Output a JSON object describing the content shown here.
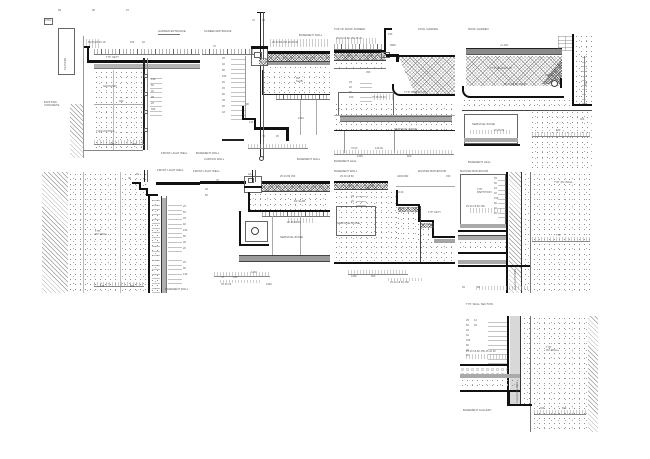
{
  "sheet": {
    "description": "Architectural construction detail drawings sheet, nine section details",
    "colors": {
      "ink": "#1a1a1a",
      "mid_grey": "#8c8c8c",
      "light_grey": "#d8d8d8",
      "text": "#555555",
      "paper": "#ffffff"
    }
  },
  "panels": [
    {
      "id": "t1",
      "name": "garden-entrance-detail",
      "labels": [
        {
          "t": "05",
          "x": 58,
          "y": 9,
          "s": 2.6
        },
        {
          "t": "06",
          "x": 92,
          "y": 9,
          "s": 2.6
        },
        {
          "t": "07",
          "x": 126,
          "y": 9,
          "s": 2.6
        },
        {
          "t": "CTRL",
          "x": 45,
          "y": 20,
          "s": 2.4
        },
        {
          "t": "PLANTER",
          "x": 64,
          "y": 70,
          "r": -90,
          "s": 2.6
        },
        {
          "t": "GARDEN ENTRANCE",
          "x": 158,
          "y": 30,
          "s": 2.7
        },
        {
          "t": "50 80 25 40 18",
          "x": 88,
          "y": 41,
          "s": 2.5
        },
        {
          "t": "150",
          "x": 130,
          "y": 41,
          "s": 2.5
        },
        {
          "t": "40",
          "x": 142,
          "y": 41,
          "s": 2.5
        },
        {
          "t": "TYP. SETT",
          "x": 106,
          "y": 56,
          "s": 2.5
        },
        {
          "t": "GROUND",
          "x": 103,
          "y": 85,
          "s": 3
        },
        {
          "t": "300",
          "x": 119,
          "y": 100,
          "s": 2.5
        },
        {
          "t": "EXISTING\nCONCRETE",
          "x": 44,
          "y": 101,
          "s": 2.7
        },
        {
          "t": "TILE PAVING",
          "x": 96,
          "y": 130,
          "s": 3
        },
        {
          "t": "150",
          "x": 151,
          "y": 78,
          "s": 2.5
        },
        {
          "t": "80",
          "x": 151,
          "y": 84,
          "s": 2.5
        },
        {
          "t": "40",
          "x": 151,
          "y": 90,
          "s": 2.5
        },
        {
          "t": "25",
          "x": 151,
          "y": 96,
          "s": 2.5
        },
        {
          "t": "20",
          "x": 151,
          "y": 102,
          "s": 2.5
        },
        {
          "t": "300",
          "x": 151,
          "y": 108,
          "s": 2.5
        },
        {
          "t": "185",
          "x": 110,
          "y": 143,
          "s": 2.5
        },
        {
          "t": "260",
          "x": 132,
          "y": 143,
          "s": 2.5
        },
        {
          "t": "FRONT LIGHT WELL",
          "x": 161,
          "y": 152,
          "s": 2.7
        },
        {
          "t": "BASEMENT WALL",
          "x": 196,
          "y": 152,
          "s": 2.7
        }
      ]
    },
    {
      "id": "t2",
      "name": "screen-entrance-detail",
      "labels": [
        {
          "t": "SCREEN ENTRANCE",
          "x": 204,
          "y": 30,
          "s": 2.7
        },
        {
          "t": "BASEMENT WALL",
          "x": 299,
          "y": 34,
          "s": 2.7
        },
        {
          "t": "70",
          "x": 252,
          "y": 19,
          "s": 2.5
        },
        {
          "t": "45",
          "x": 262,
          "y": 19,
          "s": 2.5
        },
        {
          "t": "70",
          "x": 213,
          "y": 45,
          "s": 2.5
        },
        {
          "t": "25 40 80 150 20 45 90",
          "x": 272,
          "y": 41,
          "s": 2.5
        },
        {
          "t": "25",
          "x": 222,
          "y": 57,
          "s": 2.5
        },
        {
          "t": "40",
          "x": 222,
          "y": 63,
          "s": 2.5
        },
        {
          "t": "80",
          "x": 222,
          "y": 69,
          "s": 2.5
        },
        {
          "t": "150",
          "x": 222,
          "y": 75,
          "s": 2.5
        },
        {
          "t": "20",
          "x": 222,
          "y": 81,
          "s": 2.5
        },
        {
          "t": "45",
          "x": 222,
          "y": 87,
          "s": 2.5
        },
        {
          "t": "90",
          "x": 222,
          "y": 93,
          "s": 2.5
        },
        {
          "t": "35",
          "x": 222,
          "y": 99,
          "s": 2.5
        },
        {
          "t": "60",
          "x": 222,
          "y": 105,
          "s": 2.5
        },
        {
          "t": "18",
          "x": 222,
          "y": 111,
          "s": 2.5
        },
        {
          "t": "RC\nSLAB",
          "x": 296,
          "y": 77,
          "s": 2.5
        },
        {
          "t": "90",
          "x": 246,
          "y": 103,
          "s": 2.5
        },
        {
          "t": "140",
          "x": 249,
          "y": 121,
          "s": 2.5
        },
        {
          "t": "70",
          "x": 262,
          "y": 135,
          "s": 2.5
        },
        {
          "t": "45",
          "x": 276,
          "y": 135,
          "s": 2.5
        },
        {
          "t": "2120",
          "x": 298,
          "y": 117,
          "s": 2.5
        },
        {
          "t": "CURTAIN WALL",
          "x": 204,
          "y": 158,
          "s": 2.7
        },
        {
          "t": "BASEMENT WALL",
          "x": 297,
          "y": 158,
          "s": 2.7
        }
      ]
    },
    {
      "id": "t3",
      "name": "roof-screed-detail",
      "labels": [
        {
          "t": "TOP OF ROOF SCREED",
          "x": 334,
          "y": 28,
          "s": 2.7
        },
        {
          "t": "POOL GARDEN",
          "x": 418,
          "y": 28,
          "s": 2.7
        },
        {
          "t": "25 40 18 80 150 45 20",
          "x": 336,
          "y": 37,
          "s": 2.5
        },
        {
          "t": "150",
          "x": 388,
          "y": 33,
          "s": 2.5
        },
        {
          "t": "RWP",
          "x": 390,
          "y": 44,
          "s": 2.5
        },
        {
          "t": "450",
          "x": 366,
          "y": 71,
          "s": 2.5
        },
        {
          "t": "25",
          "x": 349,
          "y": 81,
          "s": 2.5
        },
        {
          "t": "40",
          "x": 349,
          "y": 86,
          "s": 2.5
        },
        {
          "t": "80",
          "x": 349,
          "y": 91,
          "s": 2.5
        },
        {
          "t": "150",
          "x": 349,
          "y": 96,
          "s": 2.5
        },
        {
          "t": "70 45 20 40",
          "x": 372,
          "y": 96,
          "s": 2.5
        },
        {
          "t": "TYP. BUILD-UP",
          "x": 404,
          "y": 91,
          "s": 3
        },
        {
          "t": "SERVICE ZONE",
          "x": 394,
          "y": 128,
          "s": 3
        },
        {
          "t": "70.00",
          "x": 351,
          "y": 147,
          "s": 2.5
        },
        {
          "t": "140.00",
          "x": 375,
          "y": 147,
          "s": 2.5
        },
        {
          "t": "1200",
          "x": 357,
          "y": 155,
          "s": 2.5
        },
        {
          "t": "600",
          "x": 407,
          "y": 155,
          "s": 2.5
        },
        {
          "t": "BASEMENT HALL",
          "x": 334,
          "y": 160,
          "s": 2.7
        }
      ]
    },
    {
      "id": "t4",
      "name": "roof-garden-detail",
      "labels": [
        {
          "t": "ROOF GARDEN",
          "x": 468,
          "y": 28,
          "s": 2.7
        },
        {
          "t": "+2.150",
          "x": 500,
          "y": 44,
          "s": 2.5
        },
        {
          "t": "TYP. BUILD-UP",
          "x": 490,
          "y": 67,
          "s": 3
        },
        {
          "t": "25 40 18 80 150 45",
          "x": 504,
          "y": 83,
          "s": 2.5
        },
        {
          "t": "100Ø",
          "x": 545,
          "y": 74,
          "s": 2.5
        },
        {
          "t": "SERVICE ZONE",
          "x": 472,
          "y": 123,
          "s": 3
        },
        {
          "t": "20 45 90",
          "x": 494,
          "y": 129,
          "s": 2.5
        },
        {
          "t": "600",
          "x": 556,
          "y": 129,
          "s": 2.5
        },
        {
          "t": "450",
          "x": 585,
          "y": 86,
          "r": -90,
          "s": 2.5
        },
        {
          "t": "300",
          "x": 580,
          "y": 118,
          "s": 2.5
        },
        {
          "t": "BASEMENT HALL",
          "x": 468,
          "y": 161,
          "s": 2.7
        }
      ]
    },
    {
      "id": "m1",
      "name": "front-lightwell-wall-detail",
      "labels": [
        {
          "t": "FRONT LIGHT WELL",
          "x": 157,
          "y": 169,
          "s": 2.7
        },
        {
          "t": "70",
          "x": 128,
          "y": 177,
          "s": 2.5
        },
        {
          "t": "45",
          "x": 136,
          "y": 173,
          "s": 2.5
        },
        {
          "t": "TYP.\nRC WALL",
          "x": 95,
          "y": 230,
          "s": 2.7
        },
        {
          "t": "25",
          "x": 183,
          "y": 205,
          "s": 2.5
        },
        {
          "t": "50",
          "x": 183,
          "y": 211,
          "s": 2.5
        },
        {
          "t": "18",
          "x": 183,
          "y": 217,
          "s": 2.5
        },
        {
          "t": "40",
          "x": 183,
          "y": 223,
          "s": 2.5
        },
        {
          "t": "150",
          "x": 183,
          "y": 229,
          "s": 2.5
        },
        {
          "t": "80",
          "x": 183,
          "y": 235,
          "s": 2.5
        },
        {
          "t": "30",
          "x": 183,
          "y": 241,
          "s": 2.5
        },
        {
          "t": "20",
          "x": 183,
          "y": 247,
          "s": 2.5
        },
        {
          "t": "45",
          "x": 183,
          "y": 261,
          "s": 2.5
        },
        {
          "t": "90",
          "x": 183,
          "y": 267,
          "s": 2.5
        },
        {
          "t": "120",
          "x": 183,
          "y": 273,
          "s": 2.5
        },
        {
          "t": "185",
          "x": 100,
          "y": 285,
          "s": 2.5
        },
        {
          "t": "260",
          "x": 130,
          "y": 285,
          "s": 2.5
        },
        {
          "t": "BASEMENT WALL",
          "x": 165,
          "y": 288,
          "s": 2.7
        }
      ]
    },
    {
      "id": "m2",
      "name": "basement-hall-soffit-detail",
      "labels": [
        {
          "t": "FRONT LIGHT WELL",
          "x": 193,
          "y": 170,
          "s": 2.7
        },
        {
          "t": "AA",
          "x": 248,
          "y": 173,
          "s": 2.5
        },
        {
          "t": "70",
          "x": 216,
          "y": 179,
          "s": 2.5
        },
        {
          "t": "25",
          "x": 205,
          "y": 188,
          "s": 2.5
        },
        {
          "t": "50",
          "x": 205,
          "y": 194,
          "s": 2.5
        },
        {
          "t": "25 40 80 150",
          "x": 280,
          "y": 175,
          "s": 2.5
        },
        {
          "t": "RC SLAB",
          "x": 294,
          "y": 200,
          "s": 2.5
        },
        {
          "t": "20 45 90 35",
          "x": 287,
          "y": 221,
          "s": 2.5
        },
        {
          "t": "SERVICE ZONE",
          "x": 280,
          "y": 236,
          "s": 3
        },
        {
          "t": "1200",
          "x": 251,
          "y": 271,
          "s": 2.5
        },
        {
          "t": "70",
          "x": 221,
          "y": 276,
          "s": 2.5
        },
        {
          "t": "240",
          "x": 233,
          "y": 276,
          "s": 2.5
        },
        {
          "t": "25 40 18",
          "x": 221,
          "y": 283,
          "s": 2.5
        },
        {
          "t": "2400",
          "x": 266,
          "y": 283,
          "s": 2.5
        }
      ]
    },
    {
      "id": "m3",
      "name": "stepped-terrace-detail",
      "labels": [
        {
          "t": "BASEMENT WALL",
          "x": 334,
          "y": 170,
          "s": 2.7
        },
        {
          "t": "MASTER BATHROOM",
          "x": 418,
          "y": 170,
          "s": 2.7
        },
        {
          "t": "25 40 18 80",
          "x": 340,
          "y": 175,
          "s": 2.5
        },
        {
          "t": "GROUND",
          "x": 397,
          "y": 175,
          "s": 2.5
        },
        {
          "t": "150",
          "x": 446,
          "y": 175,
          "s": 2.5
        },
        {
          "t": "150",
          "x": 365,
          "y": 187,
          "s": 2.5
        },
        {
          "t": "45",
          "x": 351,
          "y": 195,
          "s": 2.5
        },
        {
          "t": "20",
          "x": 351,
          "y": 200,
          "s": 2.5
        },
        {
          "t": "+0.00",
          "x": 397,
          "y": 191,
          "s": 2.5
        },
        {
          "t": "TYP. SETT",
          "x": 428,
          "y": 211,
          "s": 2.5
        },
        {
          "t": "SERVICE ZONE",
          "x": 337,
          "y": 222,
          "s": 3
        },
        {
          "t": "1200",
          "x": 351,
          "y": 275,
          "s": 2.5
        },
        {
          "t": "600",
          "x": 371,
          "y": 275,
          "s": 2.5
        },
        {
          "t": "25 40 18 80 150",
          "x": 390,
          "y": 281,
          "s": 2.5
        }
      ]
    },
    {
      "id": "m4",
      "name": "master-bathroom-wall-detail",
      "labels": [
        {
          "t": "MASTER BATHROOM",
          "x": 460,
          "y": 170,
          "s": 2.7
        },
        {
          "t": "TYP. RC WALL",
          "x": 554,
          "y": 181,
          "s": 2.7
        },
        {
          "t": "TYP.\nPARTITION",
          "x": 477,
          "y": 188,
          "s": 2.7
        },
        {
          "t": "25",
          "x": 494,
          "y": 177,
          "s": 2.5
        },
        {
          "t": "50",
          "x": 494,
          "y": 182,
          "s": 2.5
        },
        {
          "t": "18",
          "x": 494,
          "y": 187,
          "s": 2.5
        },
        {
          "t": "40",
          "x": 494,
          "y": 192,
          "s": 2.5
        },
        {
          "t": "150",
          "x": 494,
          "y": 197,
          "s": 2.5
        },
        {
          "t": "80",
          "x": 494,
          "y": 202,
          "s": 2.5
        },
        {
          "t": "30",
          "x": 494,
          "y": 207,
          "s": 2.5
        },
        {
          "t": "20",
          "x": 494,
          "y": 212,
          "s": 2.5
        },
        {
          "t": "25 40 18 80 150",
          "x": 466,
          "y": 205,
          "s": 2.5
        },
        {
          "t": "TYP",
          "x": 556,
          "y": 234,
          "s": 2.5
        },
        {
          "t": "CLEAR OPENING",
          "x": 514,
          "y": 290,
          "r": -90,
          "s": 2.5
        },
        {
          "t": "45",
          "x": 462,
          "y": 286,
          "s": 2.5
        },
        {
          "t": "90",
          "x": 477,
          "y": 286,
          "s": 2.5
        }
      ]
    },
    {
      "id": "b1",
      "name": "basement-gallery-wall-base-detail",
      "labels": [
        {
          "t": "TYP. WALL SECTION",
          "x": 466,
          "y": 303,
          "s": 2.7
        },
        {
          "t": "25",
          "x": 466,
          "y": 319,
          "s": 2.5
        },
        {
          "t": "50",
          "x": 466,
          "y": 324,
          "s": 2.5
        },
        {
          "t": "18",
          "x": 466,
          "y": 329,
          "s": 2.5
        },
        {
          "t": "40",
          "x": 466,
          "y": 334,
          "s": 2.5
        },
        {
          "t": "150",
          "x": 466,
          "y": 339,
          "s": 2.5
        },
        {
          "t": "80",
          "x": 466,
          "y": 344,
          "s": 2.5
        },
        {
          "t": "30",
          "x": 466,
          "y": 349,
          "s": 2.5
        },
        {
          "t": "20",
          "x": 466,
          "y": 354,
          "s": 2.5
        },
        {
          "t": "12",
          "x": 474,
          "y": 319,
          "s": 2.5
        },
        {
          "t": "45",
          "x": 474,
          "y": 324,
          "s": 2.5
        },
        {
          "t": "25 40 18 80 150 45 20 90",
          "x": 466,
          "y": 350,
          "s": 2.5
        },
        {
          "t": "TYP.\nRC WALL",
          "x": 546,
          "y": 346,
          "s": 2.7
        },
        {
          "t": "CLEAR OPENING",
          "x": 516,
          "y": 403,
          "r": -90,
          "s": 2.5
        },
        {
          "t": "BASEMENT GALLERY",
          "x": 463,
          "y": 409,
          "s": 2.7
        },
        {
          "t": "300",
          "x": 540,
          "y": 407,
          "s": 2.5
        },
        {
          "t": "600",
          "x": 562,
          "y": 407,
          "s": 2.5
        }
      ]
    }
  ]
}
